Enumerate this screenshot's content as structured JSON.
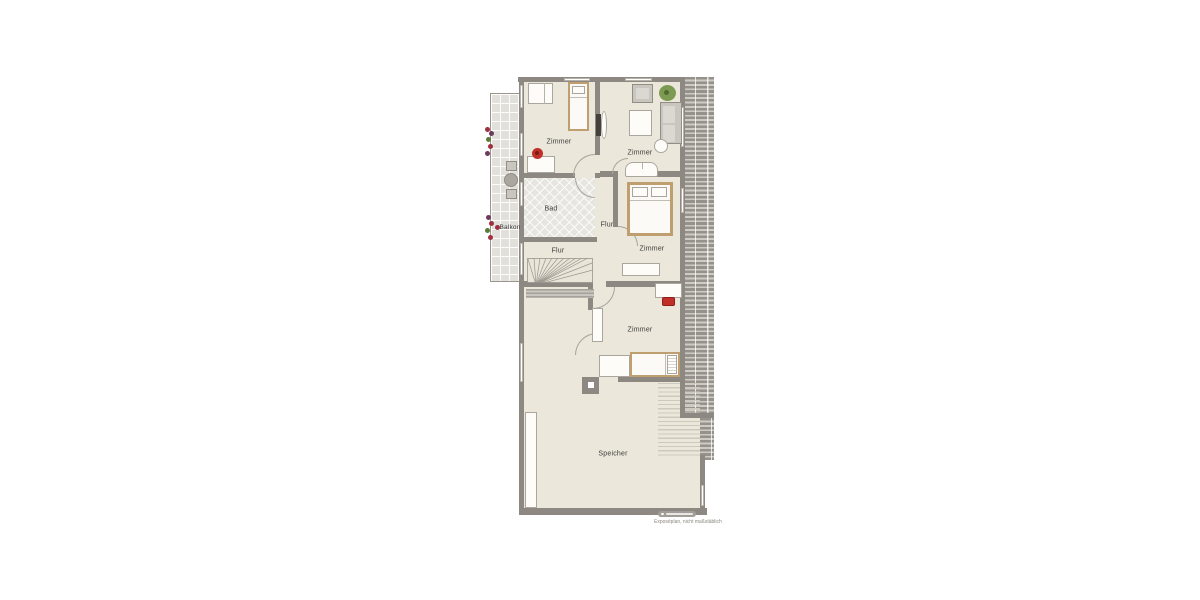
{
  "plan": {
    "rooms": {
      "zimmer_top_left": "Zimmer",
      "zimmer_top_right": "Zimmer",
      "bad": "Bad",
      "flur_upper": "Flur",
      "flur_lower": "Flur",
      "zimmer_mid_right": "Zimmer",
      "zimmer_lower": "Zimmer",
      "speicher": "Speicher",
      "balkon": "Balkon"
    },
    "watermark": {
      "caption": "Exposéplan, nicht maßstäblich"
    },
    "colors": {
      "wall": "#8d8881",
      "floor": "#ebe7da",
      "tile": "#e2e0db",
      "hatch_dark": "#96918a",
      "hatch_light": "#cecbc5",
      "accent_red": "#c03028",
      "plant_green": "#7d9a52",
      "wood": "#bf9e6f"
    }
  }
}
